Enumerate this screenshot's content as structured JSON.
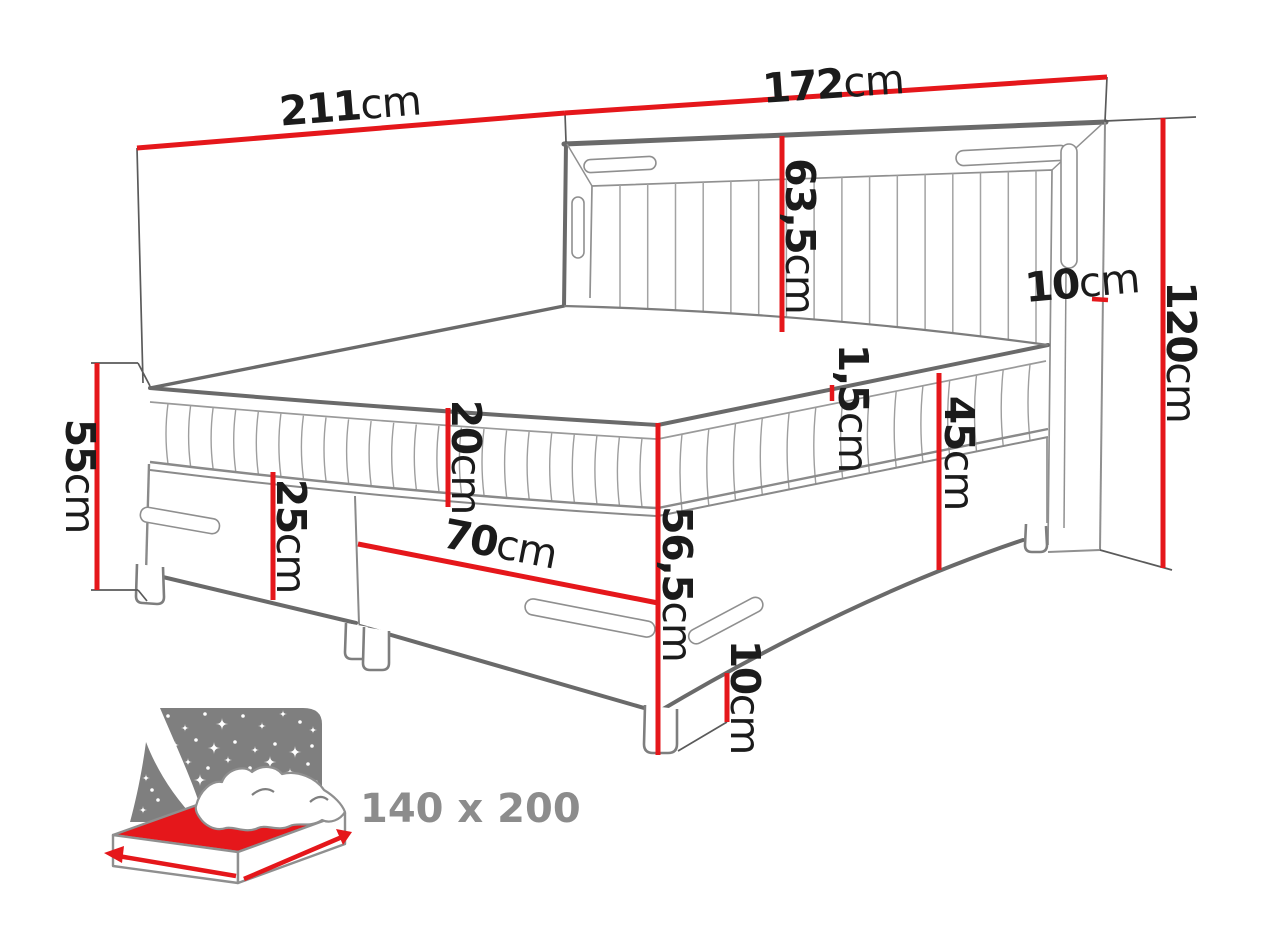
{
  "diagram": {
    "title": "bed-dimension-diagram",
    "dimensions": {
      "total_length": {
        "value": "211",
        "unit": "cm"
      },
      "headboard_width": {
        "value": "172",
        "unit": "cm"
      },
      "headboard_panel_height": {
        "value": "63,5",
        "unit": "cm"
      },
      "headboard_side_width": {
        "value": "10",
        "unit": "cm"
      },
      "headboard_height": {
        "value": "120",
        "unit": "cm"
      },
      "side_height": {
        "value": "55",
        "unit": "cm"
      },
      "mattress_height": {
        "value": "20",
        "unit": "cm"
      },
      "base_front_height": {
        "value": "25",
        "unit": "cm"
      },
      "base_segment_width": {
        "value": "70",
        "unit": "cm"
      },
      "topper_height": {
        "value": "1,5",
        "unit": "cm"
      },
      "base_side_height": {
        "value": "45",
        "unit": "cm"
      },
      "platform_height": {
        "value": "56,5",
        "unit": "cm"
      },
      "leg_height": {
        "value": "10",
        "unit": "cm"
      }
    },
    "size_badge": {
      "label": "140 x 200"
    },
    "colors": {
      "dimension_red": "#e5171b",
      "line_gray": "#6a6a6a",
      "icon_panel_gray": "#7f7f7f",
      "badge_text_gray": "#8c8c8c",
      "text_black": "#1b1b1b"
    }
  }
}
